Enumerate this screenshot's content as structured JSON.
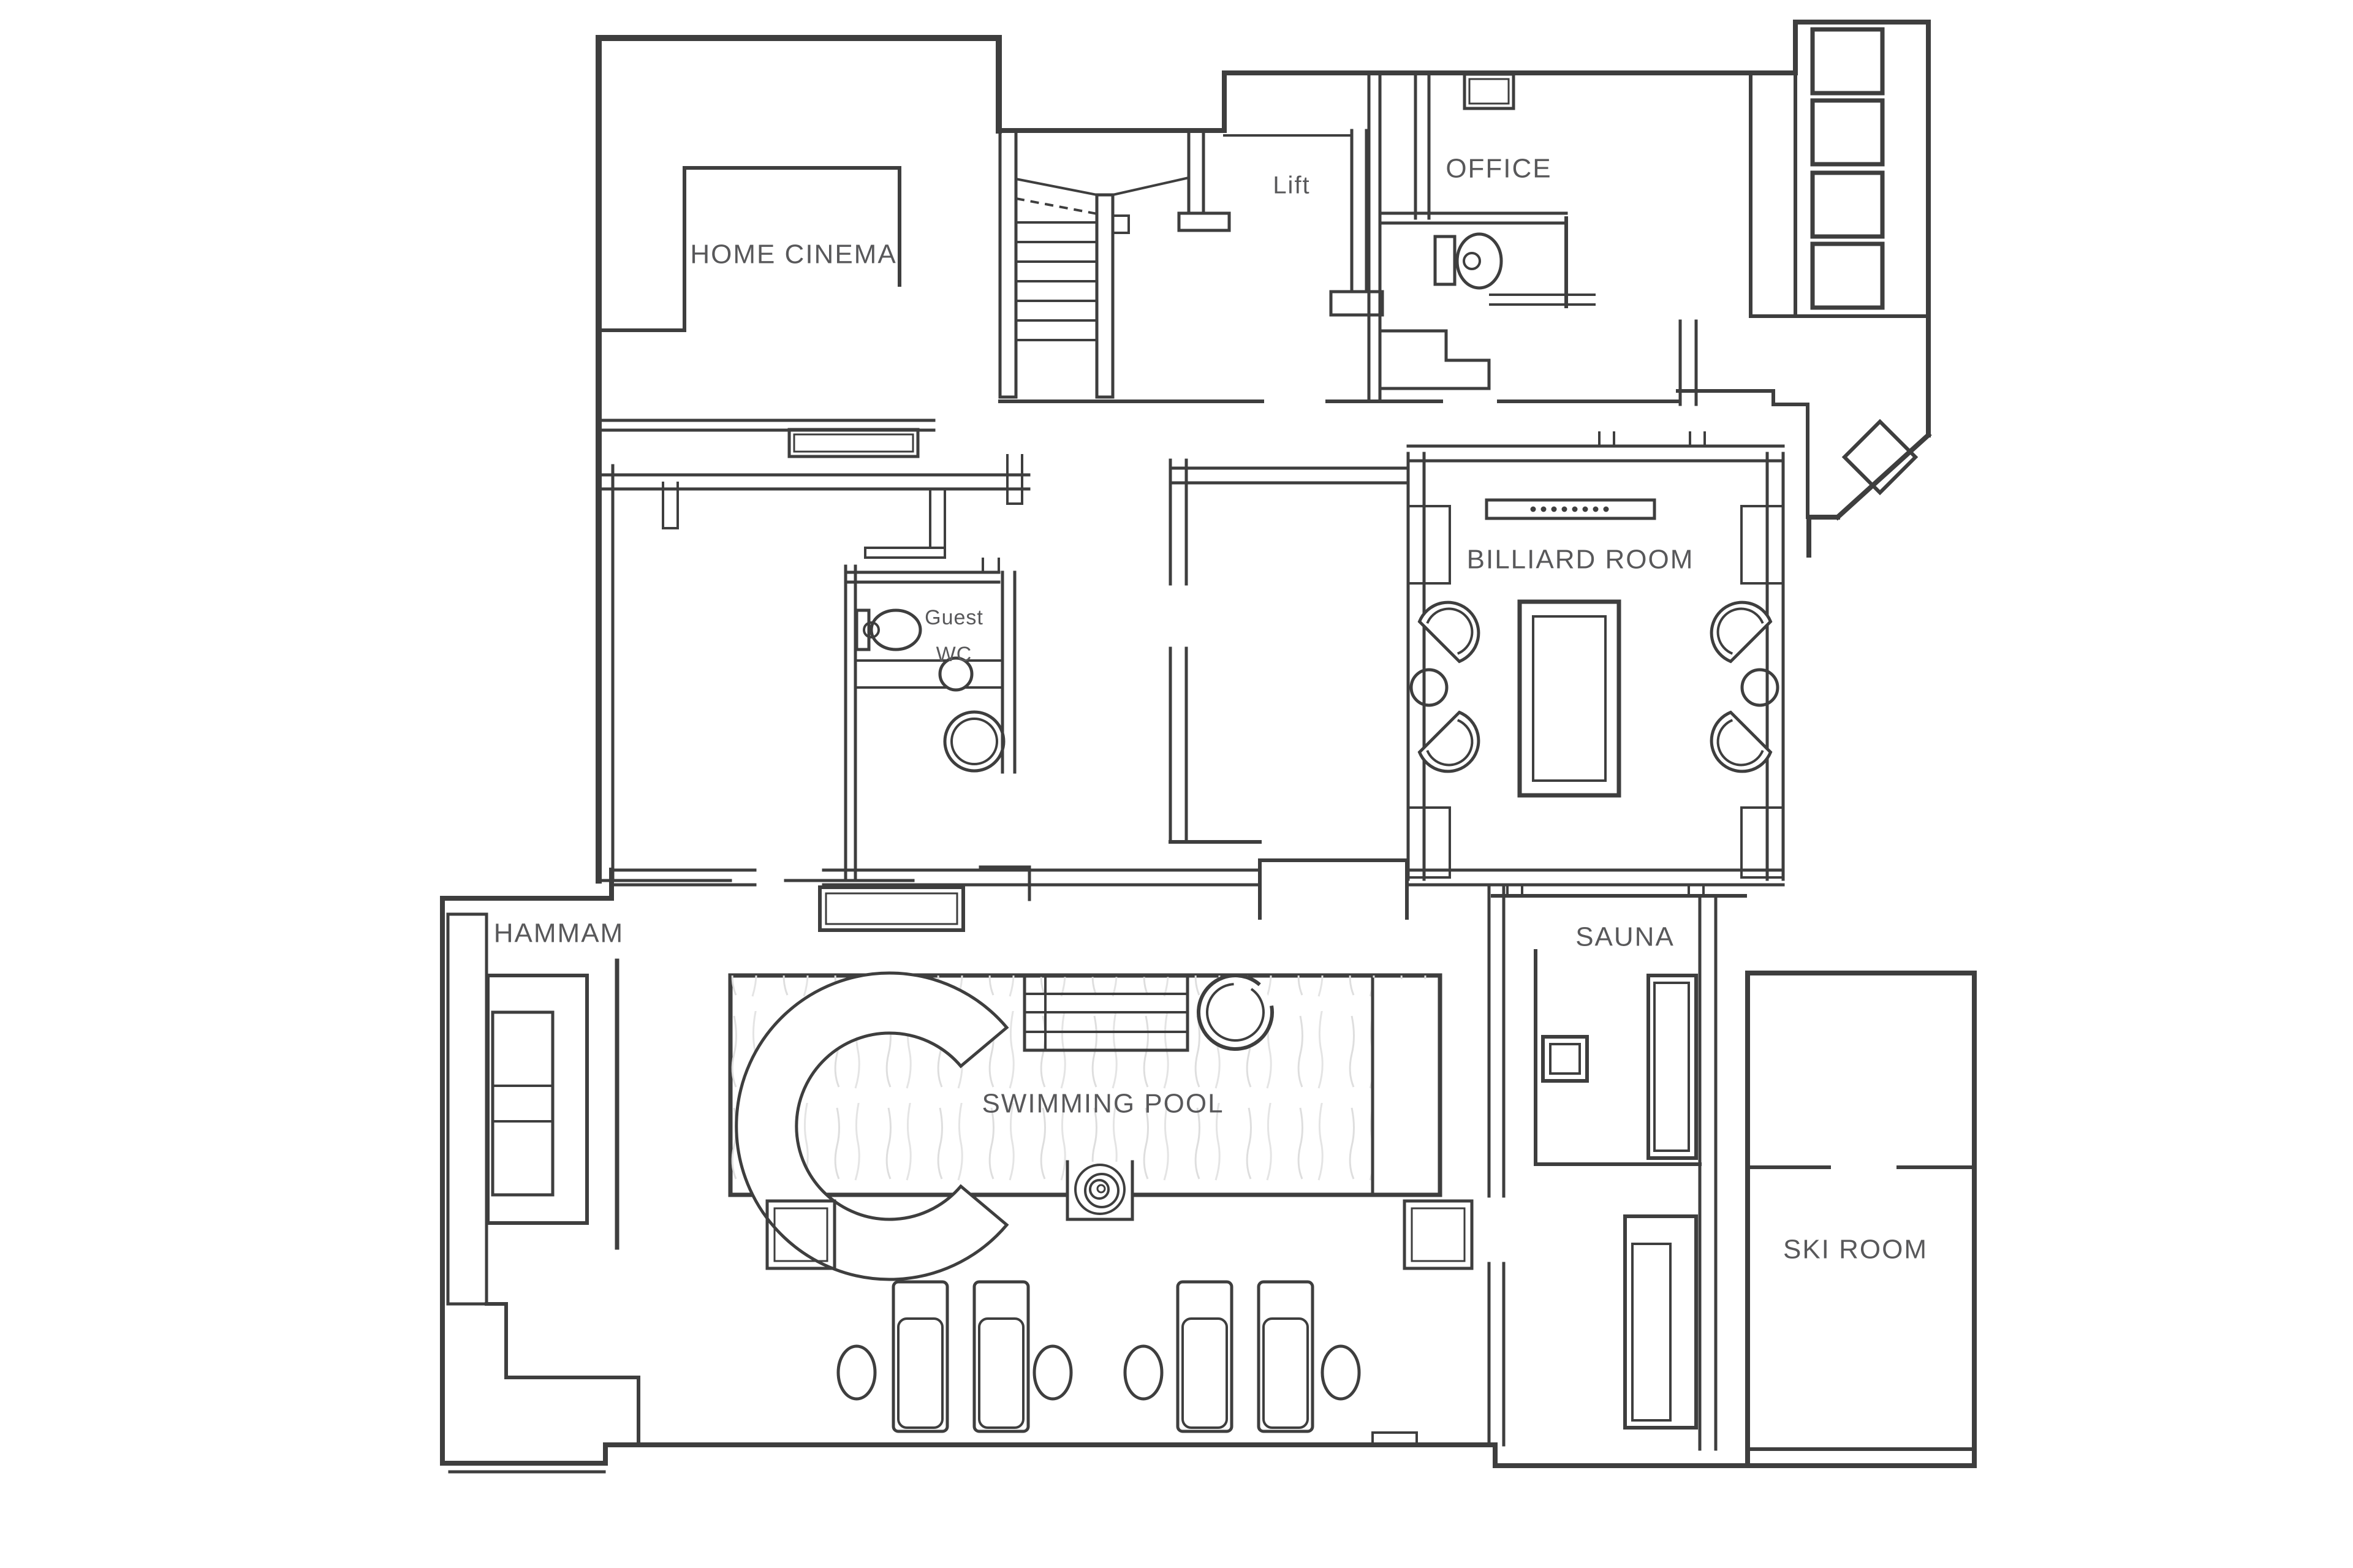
{
  "plan": {
    "type": "architectural-floor-plan",
    "background": "#ffffff",
    "wall_color": "#3e3e3e",
    "label_color": "#58585a",
    "pool_fill": "#ececec",
    "window_fill": "#d6d6d6",
    "labels": {
      "home_cinema": "HOME CINEMA",
      "lift": "Lift",
      "office": "OFFICE",
      "billiard_room": "BILLIARD ROOM",
      "guest_wc_line1": "Guest",
      "guest_wc_line2": "WC",
      "hammam": "HAMMAM",
      "sauna": "SAUNA",
      "swimming_pool": "SWIMMING POOL",
      "ski_room": "SKI ROOM"
    },
    "fixtures": {
      "staircase": "u-shaped staircase with winders",
      "lift": "lift shaft",
      "office_wc_toilet": "toilet",
      "guest_wc_toilet": "toilet",
      "guest_wc_sink": "round washbasin",
      "guest_wc_shower": "round shower basin",
      "wardrobe_closets": "4 storage closets",
      "billiard_table": "billiard table",
      "billiard_chairs": "4 fan armchairs with 2 round side tables",
      "billiard_sideboard": "sideboard with bottles",
      "hammam_bench": "tiered hammam bench",
      "sauna_stove": "sauna stove",
      "sauna_bench": "sauna bench",
      "pool_curve": "curved pool feature",
      "pool_steps": "pool entry steps",
      "pool_jacuzzi": "round jacuzzi",
      "pool_spiral": "spiral pool stair",
      "sun_loungers": "4 sun loungers with side tables",
      "deck_stools": "2 square deck stools"
    }
  }
}
